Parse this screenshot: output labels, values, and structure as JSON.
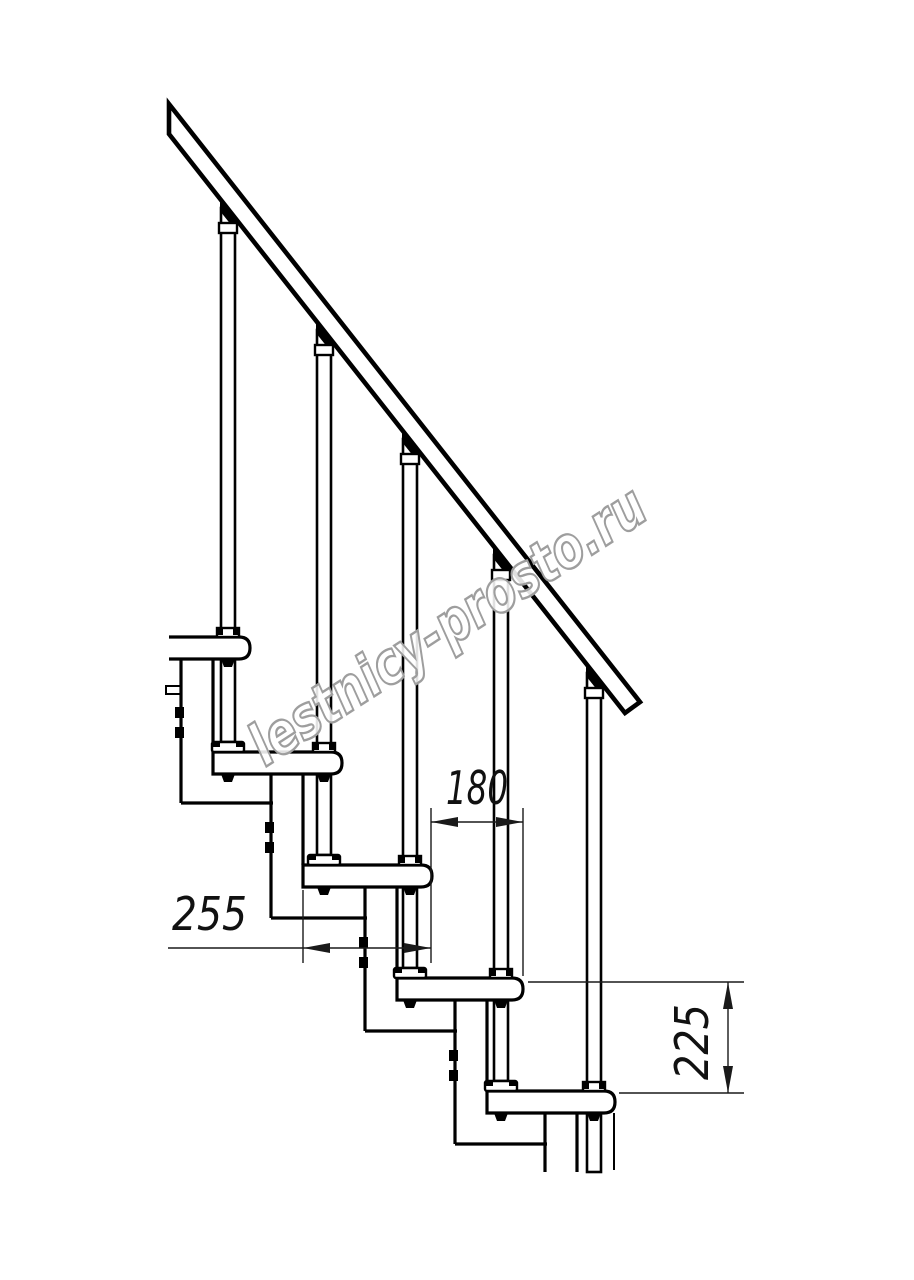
{
  "page": {
    "background_color": "#ffffff",
    "line_color": "#000000"
  },
  "watermark": {
    "text": "lestnicy-prosto.ru",
    "color": "#9e9e9e"
  },
  "dimensions": {
    "step_offset": {
      "label": "180"
    },
    "tread_depth": {
      "label": "255"
    },
    "riser_height": {
      "label": "225"
    }
  }
}
